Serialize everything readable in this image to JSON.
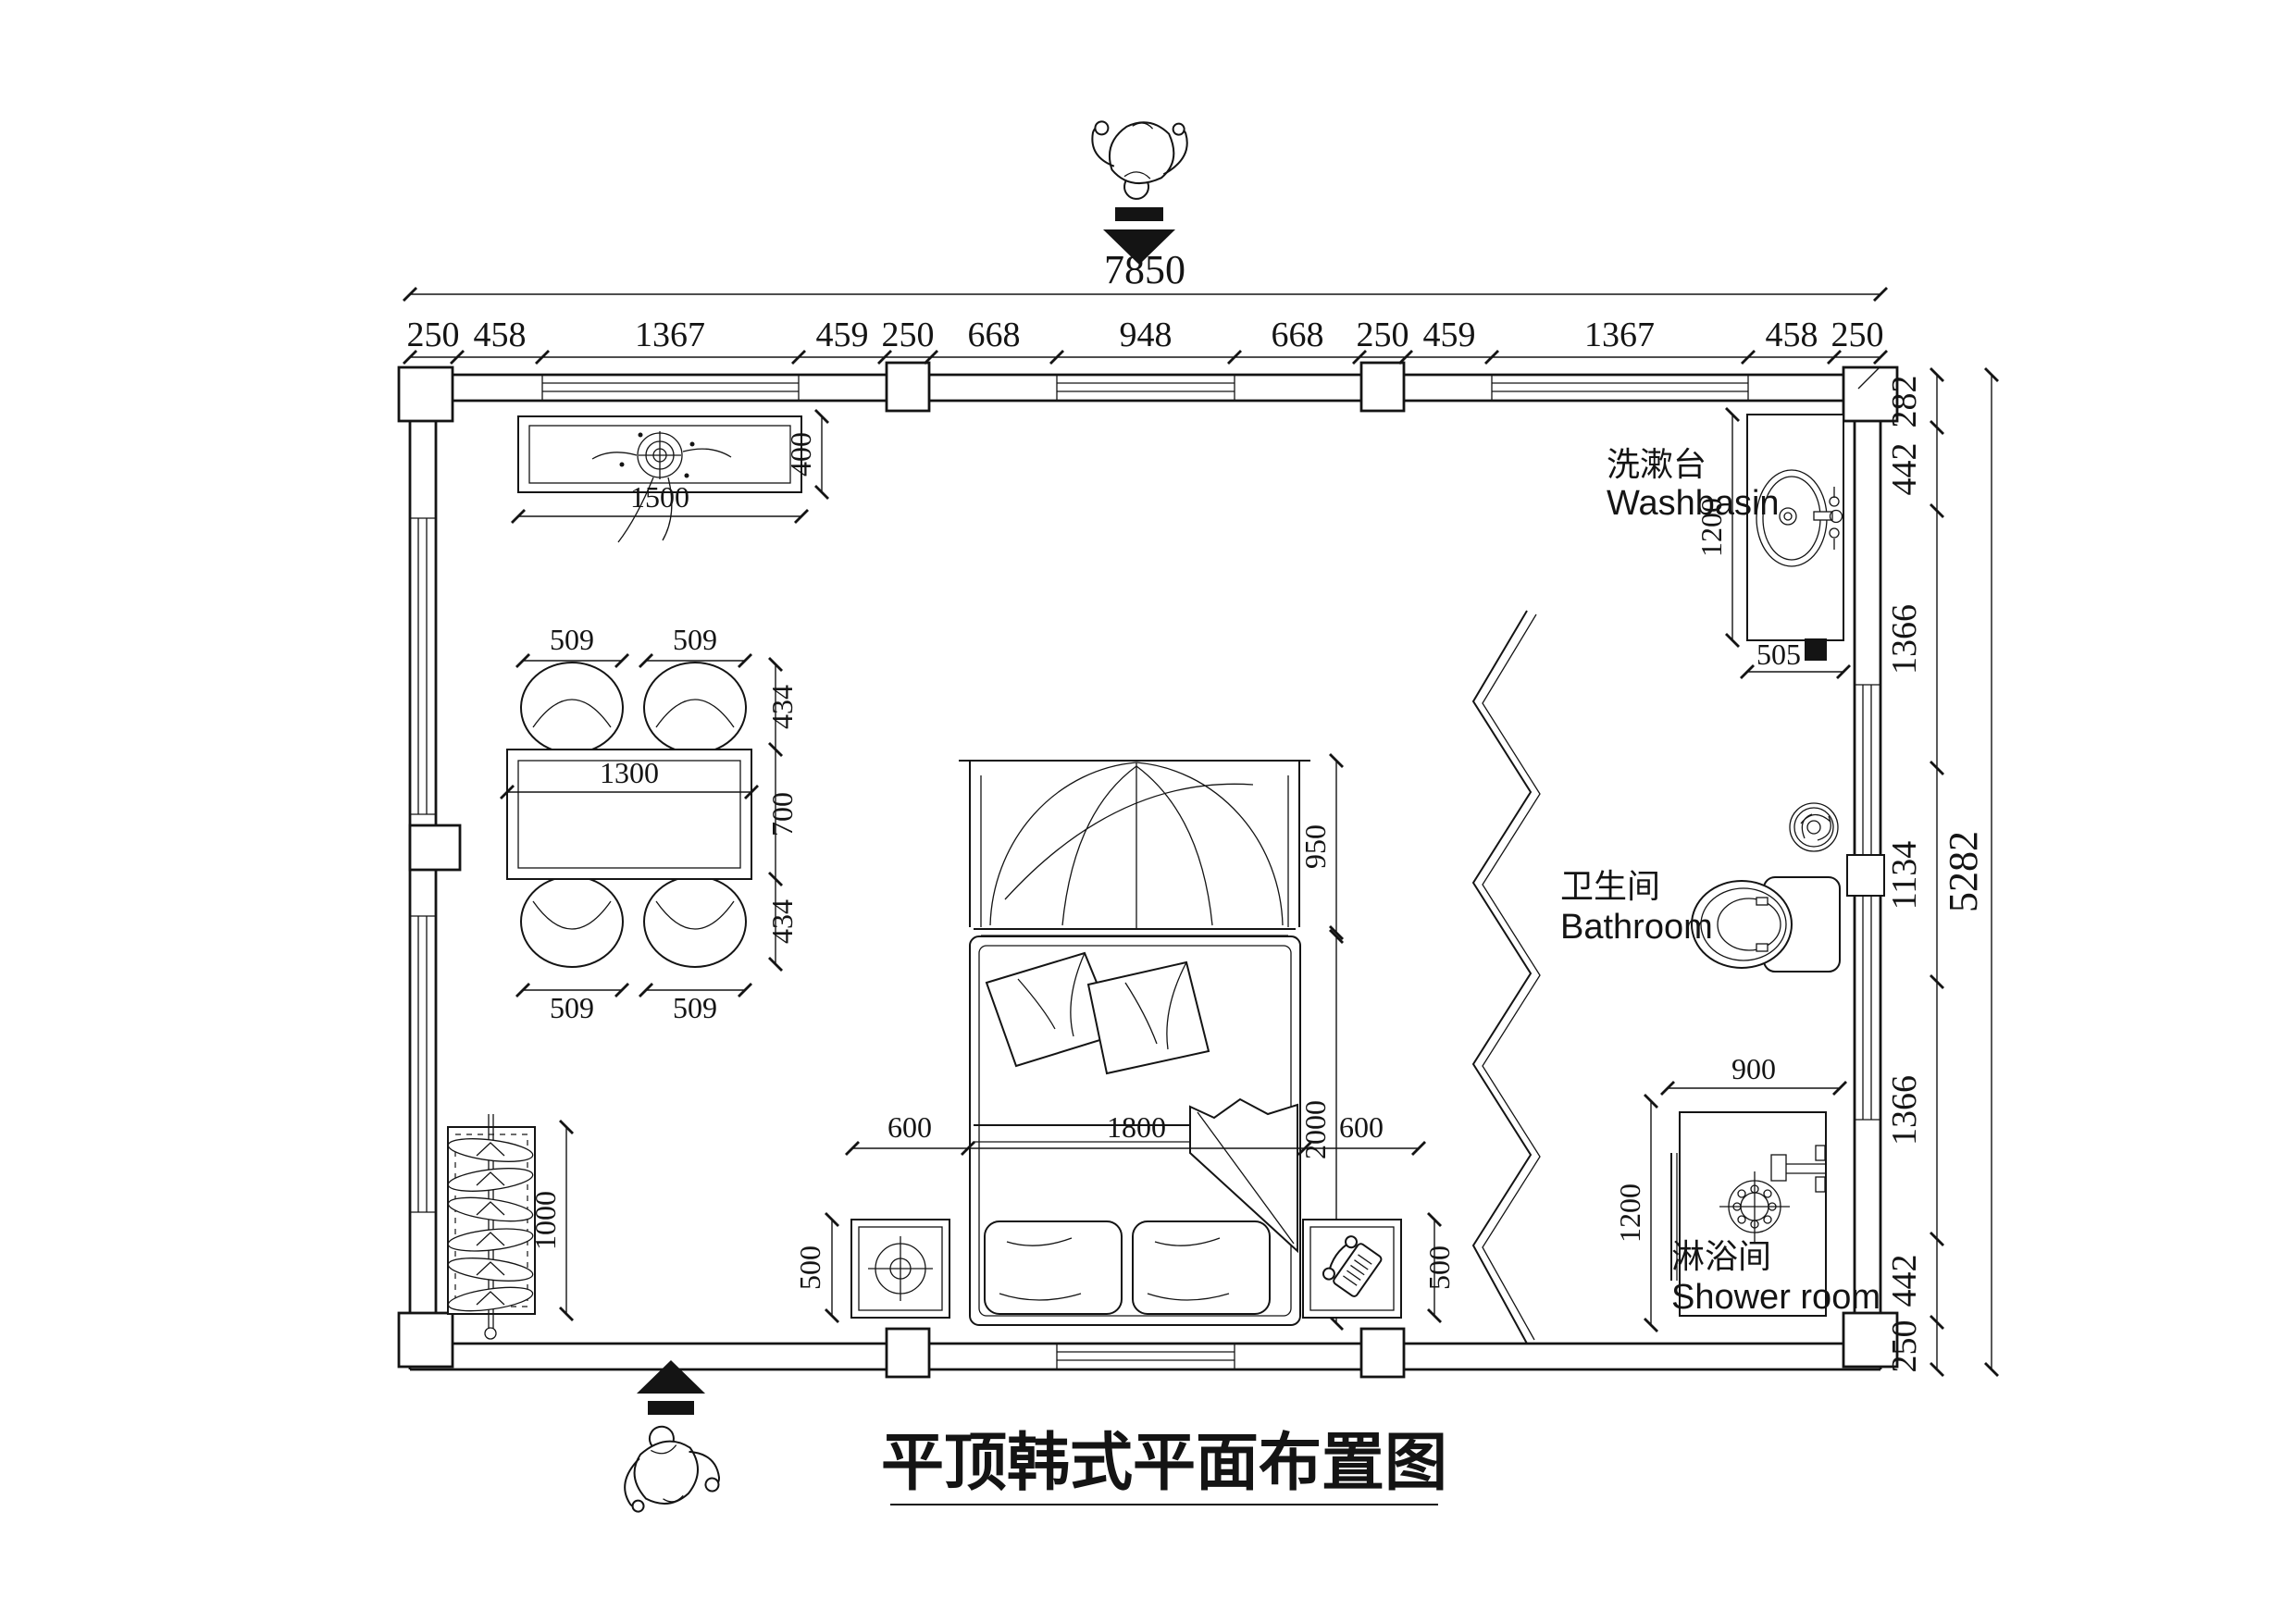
{
  "title": {
    "text": "平顶韩式平面布置图"
  },
  "dims": {
    "top": {
      "total": "7850",
      "chain": [
        "250",
        "458",
        "1367",
        "459",
        "250",
        "668",
        "948",
        "668",
        "250",
        "459",
        "1367",
        "458",
        "250"
      ]
    },
    "right": {
      "total": "5282",
      "chain": [
        "282",
        "442",
        "1366",
        "1134",
        "1366",
        "442",
        "250"
      ]
    },
    "counter": {
      "width": "1500",
      "depth": "400"
    },
    "table": {
      "width": "1300",
      "top": [
        "509",
        "509"
      ],
      "bottom": [
        "509",
        "509"
      ],
      "side": [
        "434",
        "700",
        "434"
      ]
    },
    "bed": {
      "row": [
        "600",
        "1800",
        "600"
      ],
      "length": "2000",
      "headboard": "950"
    },
    "nightstand": {
      "left": "500",
      "right": "500"
    },
    "rack": {
      "width": "1000"
    },
    "washbasin": {
      "depth": "1200",
      "width": "505"
    },
    "shower": {
      "width": "900",
      "depth": "1200"
    }
  },
  "rooms": {
    "washbasin": {
      "cn": "洗漱台",
      "en": "Washbasin"
    },
    "bathroom": {
      "cn": "卫生间",
      "en": "Bathroom"
    },
    "shower": {
      "cn": "淋浴间",
      "en": "Shower room"
    }
  }
}
